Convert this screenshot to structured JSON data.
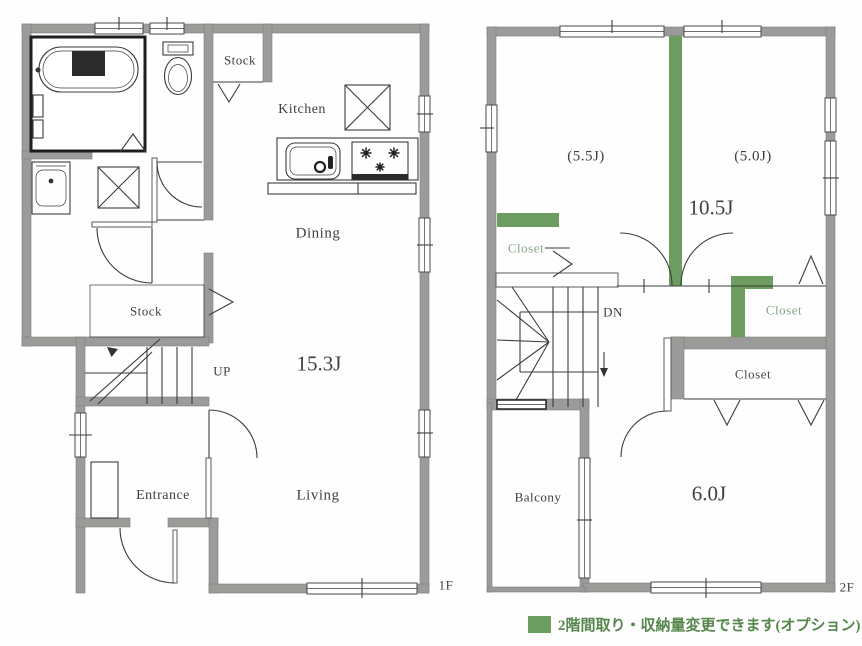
{
  "floor1": {
    "label": "1F",
    "rooms": {
      "stock_top": "Stock",
      "kitchen": "Kitchen",
      "dining": "Dining",
      "stock_mid": "Stock",
      "up": "UP",
      "ldk_size": "15.3J",
      "entrance": "Entrance",
      "living": "Living"
    }
  },
  "floor2": {
    "label": "2F",
    "rooms": {
      "room_a_size": "(5.5J)",
      "room_b_size": "(5.0J)",
      "hall_size": "10.5J",
      "closet_left": "Closet",
      "down": "DN",
      "closet_right": "Closet",
      "closet_south": "Closet",
      "balcony": "Balcony",
      "room_c_size": "6.0J"
    }
  },
  "legend": {
    "text": "2階間取り・収納量変更できます(オプション)"
  },
  "colors": {
    "wall_gray": "#9b9b99",
    "accent_green": "#6c9c60",
    "closet_text_green": "#85a488",
    "legend_text_green": "#55864c",
    "line": "#3c3c3c"
  }
}
